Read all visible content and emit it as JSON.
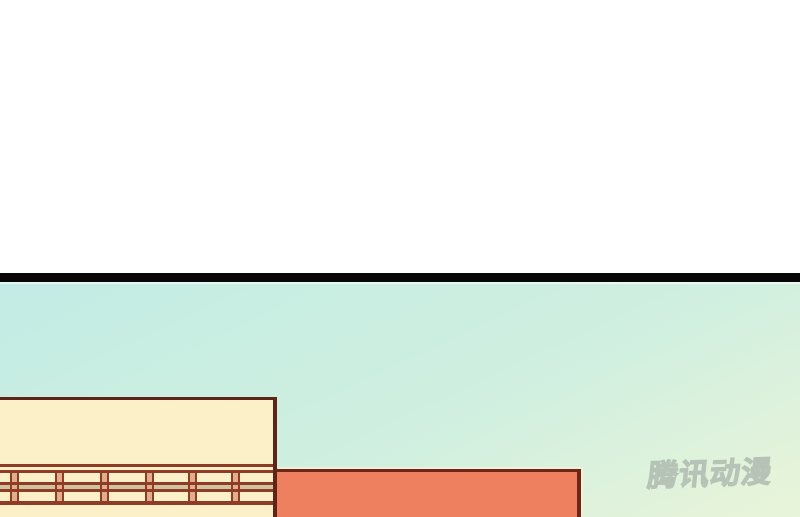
{
  "watermark": {
    "text": "腾讯动漫"
  },
  "colors": {
    "paper": "#ffffff",
    "ink": "#070707",
    "sky_top": "#c3ece4",
    "sky_mid": "#cfefe0",
    "sky_bottom": "#e9f4d9",
    "cream": "#fcf0c8",
    "outline": "#5f2418",
    "rail": "#8e3b27",
    "khaki": "#cfc49c",
    "post": "#e2ad8b",
    "orange": "#ef805f",
    "outline2": "#6e2619"
  }
}
